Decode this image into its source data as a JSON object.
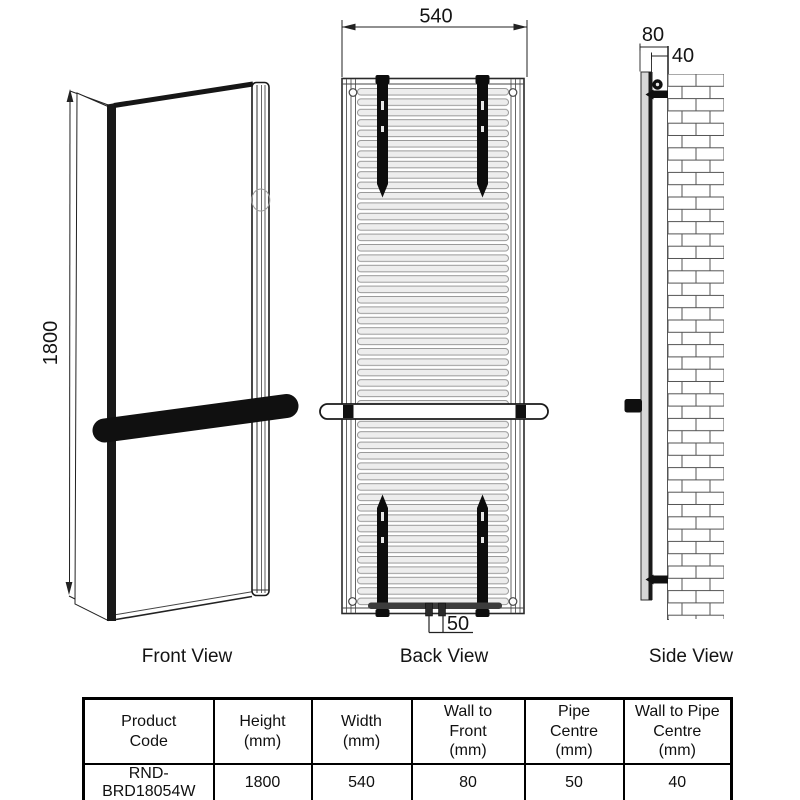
{
  "views": {
    "front": {
      "label": "Front View",
      "height_dim": "1800"
    },
    "back": {
      "label": "Back View",
      "width_dim": "540",
      "pipe_centre_dim": "50"
    },
    "side": {
      "label": "Side View",
      "wall_to_front_dim": "80",
      "wall_to_pipe_dim": "40"
    }
  },
  "table": {
    "headers": [
      "Product\nCode",
      "Height\n(mm)",
      "Width\n(mm)",
      "Wall to\nFront\n(mm)",
      "Pipe\nCentre\n(mm)",
      "Wall to Pipe\nCentre\n(mm)"
    ],
    "rows": [
      [
        "RND-BRD18054W",
        "1800",
        "540",
        "80",
        "50",
        "40"
      ]
    ]
  },
  "colors": {
    "line": "#141414",
    "bracket_black": "#0d0d0d",
    "fin_fill": "#ededed",
    "fin_stroke": "#999999",
    "side_panel_gray": "#d7d7d7",
    "background": "#ffffff"
  }
}
